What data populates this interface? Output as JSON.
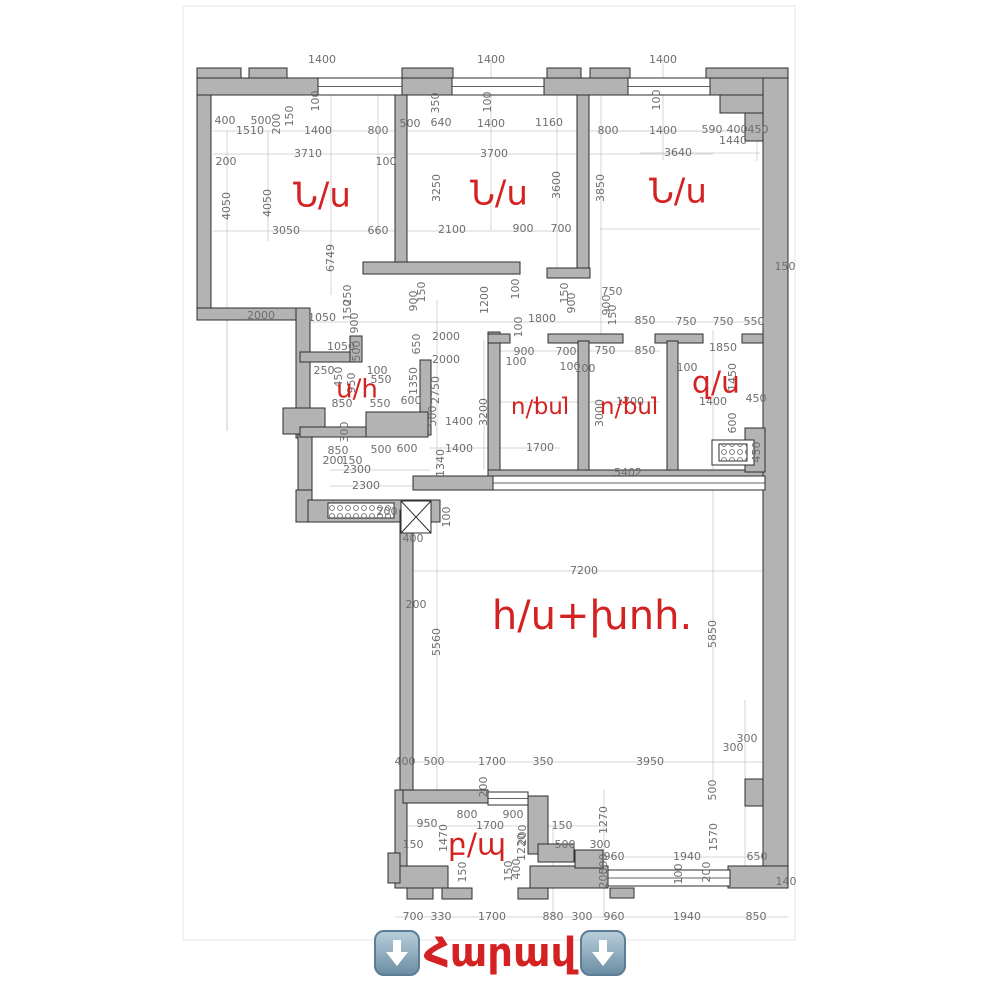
{
  "caption": {
    "text": "Հարավ",
    "arrow_icon": "down-arrow"
  },
  "colors": {
    "accent_red": "#d42222",
    "wall_fill": "#b3b3b3",
    "wall_stroke": "#2e2e2e",
    "dim_text": "#6e6e6e",
    "extension_line": "#c9c9c9",
    "arrow_blue": "#6d8ea4"
  },
  "plan": {
    "rooms": [
      {
        "t": "Ն/ս",
        "x": 322,
        "y": 197,
        "s": 34
      },
      {
        "t": "Ն/ս",
        "x": 499,
        "y": 195,
        "s": 34
      },
      {
        "t": "Ն/ս",
        "x": 678,
        "y": 193,
        "s": 34
      },
      {
        "t": "ս/հ",
        "x": 357,
        "y": 390,
        "s": 26
      },
      {
        "t": "լոգ/ս",
        "x": 540,
        "y": 408,
        "s": 23,
        "r": 180
      },
      {
        "t": "լոգ/ս",
        "x": 629,
        "y": 408,
        "s": 23,
        "r": 180
      },
      {
        "t": "զ/ս",
        "x": 716,
        "y": 384,
        "s": 30
      },
      {
        "t": "հ/ս+խոհ.",
        "x": 592,
        "y": 618,
        "s": 40
      },
      {
        "t": "բ/պ",
        "x": 477,
        "y": 846,
        "s": 30
      }
    ],
    "dims": [
      [
        "1400",
        322,
        60
      ],
      [
        "1400",
        491,
        60
      ],
      [
        "1400",
        663,
        60
      ],
      [
        "100",
        316,
        101,
        1
      ],
      [
        "400",
        225,
        121
      ],
      [
        "500",
        261,
        121
      ],
      [
        "1510",
        250,
        131
      ],
      [
        "200",
        277,
        124,
        1
      ],
      [
        "150",
        290,
        116,
        1
      ],
      [
        "1400",
        318,
        131
      ],
      [
        "800",
        378,
        131
      ],
      [
        "3710",
        308,
        154
      ],
      [
        "100",
        386,
        162
      ],
      [
        "200",
        226,
        162
      ],
      [
        "4050",
        227,
        206,
        1
      ],
      [
        "4050",
        268,
        203,
        1
      ],
      [
        "3050",
        286,
        231
      ],
      [
        "660",
        378,
        231
      ],
      [
        "6749",
        331,
        258,
        1
      ],
      [
        "500",
        410,
        124
      ],
      [
        "640",
        441,
        123
      ],
      [
        "1400",
        491,
        124
      ],
      [
        "1160",
        549,
        123
      ],
      [
        "350",
        436,
        103,
        1
      ],
      [
        "100",
        488,
        102,
        1
      ],
      [
        "3700",
        494,
        154
      ],
      [
        "3250",
        437,
        188,
        1
      ],
      [
        "3600",
        557,
        185,
        1
      ],
      [
        "2100",
        452,
        230
      ],
      [
        "900",
        523,
        229
      ],
      [
        "700",
        561,
        229
      ],
      [
        "800",
        608,
        131
      ],
      [
        "1400",
        663,
        131
      ],
      [
        "590",
        712,
        130
      ],
      [
        "400",
        737,
        130
      ],
      [
        "450",
        758,
        130
      ],
      [
        "1440",
        733,
        141
      ],
      [
        "3640",
        678,
        153
      ],
      [
        "100",
        657,
        100,
        1
      ],
      [
        "3850",
        601,
        188,
        1
      ],
      [
        "150",
        785,
        267
      ],
      [
        "2000",
        261,
        316
      ],
      [
        "1050",
        322,
        318
      ],
      [
        "1050",
        341,
        347
      ],
      [
        "250",
        348,
        295,
        1
      ],
      [
        "150",
        348,
        310,
        1
      ],
      [
        "900",
        355,
        323,
        1
      ],
      [
        "900",
        414,
        301,
        1
      ],
      [
        "150",
        422,
        292,
        1
      ],
      [
        "1200",
        485,
        300,
        1
      ],
      [
        "100",
        516,
        289,
        1
      ],
      [
        "150",
        565,
        293,
        1
      ],
      [
        "900",
        572,
        303,
        1
      ],
      [
        "750",
        612,
        292
      ],
      [
        "900",
        607,
        305,
        1
      ],
      [
        "150",
        613,
        315,
        1
      ],
      [
        "1800",
        542,
        319
      ],
      [
        "100",
        519,
        327,
        1
      ],
      [
        "850",
        645,
        321
      ],
      [
        "750",
        686,
        322
      ],
      [
        "750",
        723,
        322
      ],
      [
        "550",
        754,
        322
      ],
      [
        "250",
        324,
        371
      ],
      [
        "450",
        339,
        377,
        1
      ],
      [
        "500",
        357,
        351,
        1
      ],
      [
        "950",
        352,
        383,
        1
      ],
      [
        "100",
        377,
        371
      ],
      [
        "550",
        381,
        380
      ],
      [
        "550",
        380,
        404
      ],
      [
        "850",
        342,
        404
      ],
      [
        "300",
        345,
        432,
        1
      ],
      [
        "850",
        338,
        451
      ],
      [
        "200",
        333,
        461
      ],
      [
        "150",
        352,
        461
      ],
      [
        "500",
        381,
        450
      ],
      [
        "600",
        407,
        449
      ],
      [
        "2300",
        357,
        470
      ],
      [
        "2300",
        366,
        486
      ],
      [
        "650",
        417,
        344,
        1
      ],
      [
        "1350",
        414,
        381,
        1
      ],
      [
        "600",
        411,
        401
      ],
      [
        "2000",
        446,
        337
      ],
      [
        "2000",
        446,
        360
      ],
      [
        "2750",
        436,
        390,
        1
      ],
      [
        "500",
        433,
        416,
        1
      ],
      [
        "1400",
        459,
        422
      ],
      [
        "1400",
        459,
        449
      ],
      [
        "1340",
        441,
        463,
        1
      ],
      [
        "3200",
        484,
        412,
        1
      ],
      [
        "900",
        524,
        352
      ],
      [
        "700",
        566,
        352
      ],
      [
        "100",
        516,
        362
      ],
      [
        "100",
        570,
        367
      ],
      [
        "750",
        605,
        351
      ],
      [
        "850",
        645,
        351
      ],
      [
        "1700",
        540,
        448
      ],
      [
        "1700",
        630,
        402
      ],
      [
        "3000",
        600,
        413,
        1
      ],
      [
        "5402",
        628,
        473
      ],
      [
        "100",
        585,
        369
      ],
      [
        "1850",
        723,
        348
      ],
      [
        "100",
        687,
        368
      ],
      [
        "1450",
        733,
        377,
        1
      ],
      [
        "450",
        756,
        399
      ],
      [
        "1400",
        713,
        402
      ],
      [
        "600",
        733,
        423,
        1
      ],
      [
        "450",
        757,
        452,
        1
      ],
      [
        "100",
        447,
        517,
        1
      ],
      [
        "400",
        413,
        539
      ],
      [
        "200",
        387,
        512
      ],
      [
        "7200",
        584,
        571
      ],
      [
        "200",
        416,
        605
      ],
      [
        "5560",
        437,
        642,
        1
      ],
      [
        "5850",
        713,
        634,
        1
      ],
      [
        "300",
        747,
        739
      ],
      [
        "300",
        733,
        748
      ],
      [
        "400",
        405,
        762
      ],
      [
        "500",
        434,
        762
      ],
      [
        "1700",
        492,
        762
      ],
      [
        "350",
        543,
        762
      ],
      [
        "3950",
        650,
        762
      ],
      [
        "200",
        484,
        787,
        1
      ],
      [
        "500",
        713,
        790,
        1
      ],
      [
        "800",
        467,
        815
      ],
      [
        "900",
        513,
        815
      ],
      [
        "950",
        427,
        824
      ],
      [
        "1700",
        490,
        826
      ],
      [
        "150",
        562,
        826
      ],
      [
        "1470",
        444,
        838,
        1
      ],
      [
        "150",
        413,
        845
      ],
      [
        "200",
        523,
        835,
        1
      ],
      [
        "500",
        565,
        845
      ],
      [
        "300",
        600,
        845
      ],
      [
        "1270",
        604,
        820,
        1
      ],
      [
        "960",
        614,
        857
      ],
      [
        "1940",
        687,
        857
      ],
      [
        "650",
        757,
        857
      ],
      [
        "500",
        604,
        864,
        1
      ],
      [
        "200",
        604,
        878,
        1
      ],
      [
        "100",
        679,
        874,
        1
      ],
      [
        "200",
        707,
        872,
        1
      ],
      [
        "1570",
        714,
        837,
        1
      ],
      [
        "140",
        786,
        882
      ],
      [
        "1220",
        522,
        847,
        1
      ],
      [
        "400",
        517,
        869,
        1
      ],
      [
        "150",
        463,
        872,
        1
      ],
      [
        "150",
        509,
        871,
        1
      ],
      [
        "700",
        413,
        917
      ],
      [
        "330",
        441,
        917
      ],
      [
        "1700",
        492,
        917
      ],
      [
        "880",
        553,
        917
      ],
      [
        "300",
        582,
        917
      ],
      [
        "960",
        614,
        917
      ],
      [
        "1940",
        687,
        917
      ],
      [
        "850",
        756,
        917
      ]
    ],
    "walls": [
      [
        197,
        68,
        44,
        12
      ],
      [
        249,
        68,
        38,
        12
      ],
      [
        402,
        68,
        51,
        12
      ],
      [
        547,
        68,
        34,
        12
      ],
      [
        590,
        68,
        40,
        12
      ],
      [
        706,
        68,
        82,
        12
      ],
      [
        197,
        78,
        591,
        17
      ],
      [
        197,
        95,
        14,
        221
      ],
      [
        197,
        308,
        112,
        12
      ],
      [
        296,
        308,
        14,
        130
      ],
      [
        283,
        408,
        42,
        26
      ],
      [
        298,
        434,
        14,
        70
      ],
      [
        300,
        352,
        60,
        10
      ],
      [
        350,
        336,
        12,
        26
      ],
      [
        420,
        360,
        11,
        75
      ],
      [
        300,
        427,
        66,
        10
      ],
      [
        366,
        412,
        62,
        25
      ],
      [
        296,
        490,
        16,
        32
      ],
      [
        308,
        500,
        132,
        22
      ],
      [
        395,
        95,
        12,
        173
      ],
      [
        363,
        262,
        157,
        12
      ],
      [
        577,
        95,
        12,
        173
      ],
      [
        547,
        268,
        43,
        10
      ],
      [
        488,
        332,
        12,
        150
      ],
      [
        488,
        334,
        22,
        9
      ],
      [
        548,
        334,
        75,
        9
      ],
      [
        655,
        334,
        48,
        9
      ],
      [
        742,
        334,
        23,
        9
      ],
      [
        578,
        341,
        11,
        141
      ],
      [
        667,
        341,
        11,
        141
      ],
      [
        488,
        470,
        277,
        10
      ],
      [
        413,
        476,
        80,
        14
      ],
      [
        400,
        510,
        13,
        282
      ],
      [
        745,
        779,
        18,
        27
      ],
      [
        720,
        95,
        43,
        18
      ],
      [
        745,
        113,
        18,
        28
      ],
      [
        763,
        78,
        25,
        810
      ],
      [
        745,
        428,
        20,
        44
      ],
      [
        395,
        790,
        12,
        98
      ],
      [
        403,
        790,
        85,
        13
      ],
      [
        528,
        796,
        20,
        58
      ],
      [
        538,
        844,
        36,
        18
      ],
      [
        395,
        866,
        53,
        22
      ],
      [
        530,
        866,
        78,
        22
      ],
      [
        575,
        850,
        28,
        18
      ],
      [
        728,
        866,
        60,
        22
      ],
      [
        388,
        853,
        12,
        30
      ],
      [
        407,
        888,
        26,
        11
      ],
      [
        442,
        888,
        30,
        11
      ],
      [
        518,
        888,
        30,
        11
      ],
      [
        610,
        888,
        24,
        10
      ]
    ],
    "windows": [
      [
        318,
        78,
        84,
        17
      ],
      [
        452,
        78,
        92,
        17
      ],
      [
        628,
        78,
        82,
        17
      ],
      [
        493,
        476,
        272,
        14
      ],
      [
        488,
        792,
        40,
        13
      ],
      [
        608,
        870,
        122,
        16
      ]
    ],
    "fixtures": {
      "hatches": [
        [
          328,
          503,
          66,
          15
        ],
        [
          719,
          444,
          28,
          17
        ]
      ],
      "vent_box": [
        712,
        440,
        42,
        25
      ],
      "x_box": [
        401,
        501,
        30,
        32
      ]
    },
    "lines": {
      "h": [
        [
          213,
          131,
          560
        ],
        [
          213,
          154,
          500
        ],
        [
          213,
          231,
          360
        ],
        [
          600,
          229,
          160
        ],
        [
          300,
          322,
          470
        ],
        [
          500,
          351,
          160
        ],
        [
          500,
          402,
          160
        ],
        [
          430,
          448,
          130
        ],
        [
          413,
          571,
          350
        ],
        [
          395,
          762,
          368
        ],
        [
          407,
          826,
          200
        ],
        [
          600,
          857,
          170
        ],
        [
          395,
          917,
          393
        ],
        [
          330,
          470,
          100
        ],
        [
          330,
          486,
          100
        ],
        [
          600,
          131,
          180
        ],
        [
          640,
          153,
          120
        ]
      ],
      "v": [
        [
          227,
          131,
          300
        ],
        [
          268,
          131,
          110
        ],
        [
          331,
          95,
          200
        ],
        [
          378,
          95,
          140
        ],
        [
          491,
          60,
          170
        ],
        [
          557,
          95,
          175
        ],
        [
          601,
          95,
          240
        ],
        [
          663,
          60,
          100
        ],
        [
          713,
          330,
          140
        ],
        [
          437,
          300,
          170
        ],
        [
          484,
          340,
          130
        ],
        [
          437,
          520,
          270
        ],
        [
          713,
          480,
          300
        ],
        [
          745,
          700,
          180
        ],
        [
          604,
          790,
          127
        ],
        [
          553,
          826,
          91
        ],
        [
          227,
          316,
          115
        ],
        [
          757,
          131,
          30
        ]
      ]
    },
    "sheet": [
      183,
      6,
      612,
      934
    ]
  }
}
